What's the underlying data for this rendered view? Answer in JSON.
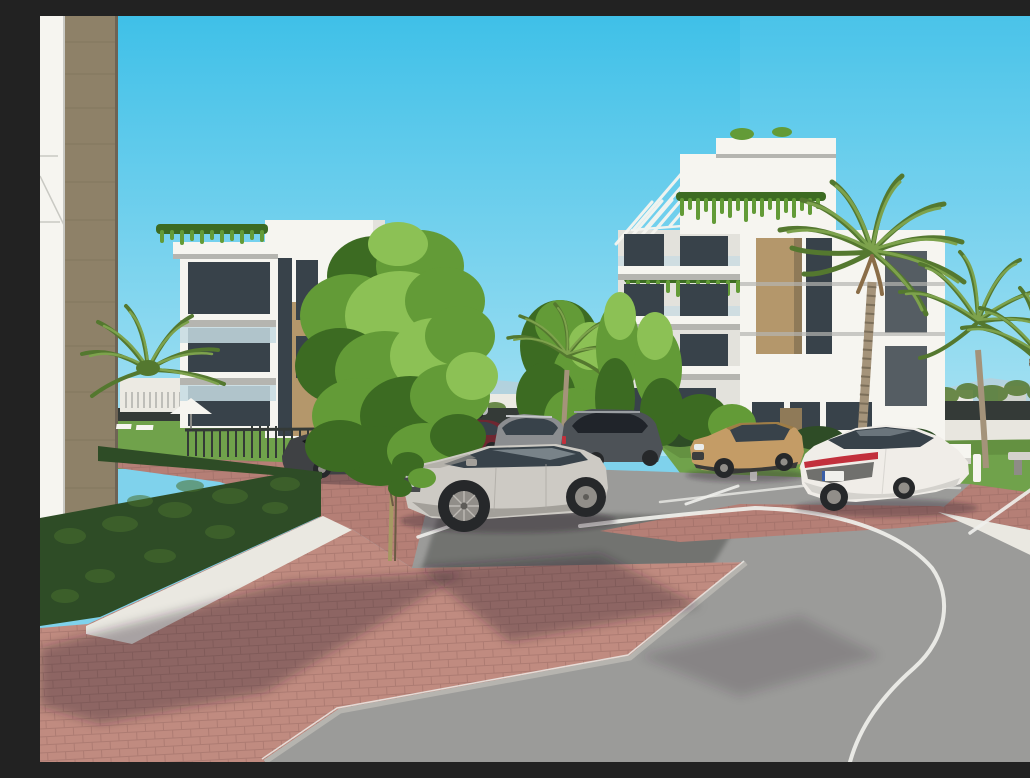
{
  "scene": {
    "type": "3d-architectural-exterior-render",
    "description": "Photorealistic architectural rendering of a modern white residential complex: two white apartment buildings with wood-tone panels, rooftop pergolas and planted balconies, surrounded by palm trees, green deciduous trees and boxwood hedges; a silver SUV, a tan compact SUV, a white sedan and several dark cars are parked along red brick sidewalks beside a curved asphalt road with white markings under a clear cyan sky.",
    "objects": [
      "left white apartment building with tan wood panel",
      "right white apartment building with rooftop pergolas and hanging plants",
      "foreground facade edge with wood column (far left)",
      "silver SUV parked in bay",
      "tan compact SUV",
      "white fastback sedan with red taillight bar",
      "dark gray sedan and SUVs in background row",
      "palm trees",
      "deciduous trees",
      "boxwood hedge and lawn",
      "white parasol and sun loungers",
      "concrete benches and bollards",
      "red brick paving and white gravel strip",
      "curved asphalt road with white edge line and parking bay lines",
      "distant low-rise skyline and perimeter fence",
      "clear cyan sky"
    ]
  },
  "colors": {
    "sky_top": "#3fc0e8",
    "sky_bottom": "#a9e2f3",
    "mountain": "#b9cfd9",
    "distant_building": "#eceae3",
    "distant_building_shade": "#cfd2cc",
    "distant_dark_building": "#4c4f5a",
    "perimeter_fence": "#343a37",
    "wall_white": "#e8e6df",
    "building_white": "#f6f5f0",
    "building_white_shade": "#e3e2dc",
    "building_soffit": "#b5b5b0",
    "wood_tan": "#b4976b",
    "wood_tan_shade": "#8f7a58",
    "left_column_wood": "#8e8168",
    "wood_grain": "#776c55",
    "window_glass": "#38424a",
    "balcony_glass": "#c6dbe2",
    "tree_light": "#8cc155",
    "tree_mid": "#639b37",
    "tree_dark": "#3c6b22",
    "palm_green": "#7da24c",
    "palm_dark": "#54782f",
    "palm_trunk": "#a4937a",
    "hedge": "#2e4c26",
    "hedge_light": "#49702f",
    "lawn": "#70a24b",
    "lawn_shade": "#577f38",
    "brick": "#c08b80",
    "brick_strip": "#b57f76",
    "brick_line": "#8a5f58",
    "gravel": "#eae8e1",
    "asphalt": "#9b9b99",
    "asphalt_dark": "#6c6d6b",
    "curb": "#b6b4af",
    "road_line": "#f0f0ec",
    "car_silver": "#cdcac4",
    "car_silver_shade": "#a3a09a",
    "car_dark_sedan": "#3f4144",
    "car_red": "#6f2731",
    "car_gray": "#8b8d90",
    "car_suv_dark": "#4d5257",
    "car_tan": "#c49c66",
    "car_tan_shade": "#96753f",
    "car_white": "#f0ede8",
    "car_white_shade": "#d4d2cd",
    "taillight_red": "#c2303c",
    "wheel_dark": "#26282a",
    "wheel_rim": "#918e89",
    "shadow": "rgba(45,35,48,0.34)",
    "flower_yellow": "#e8d24a"
  }
}
